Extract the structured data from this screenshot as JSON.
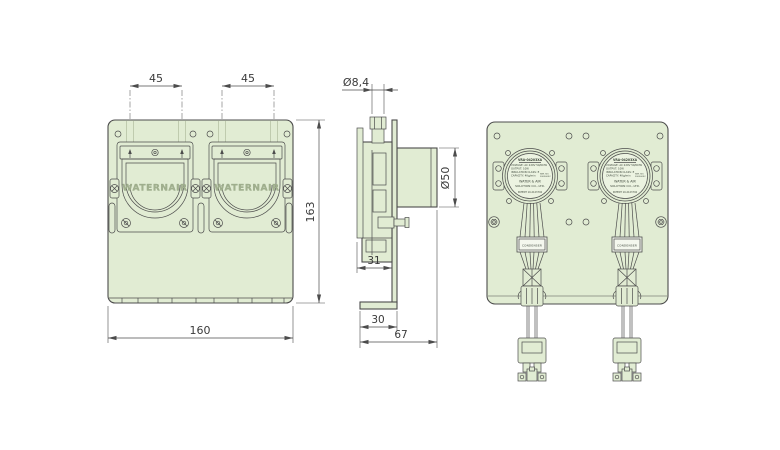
{
  "colors": {
    "background": "#ffffff",
    "panel_fill": "#e1ecd3",
    "line": "#4c4c4c",
    "dim_text": "#3a3a3a",
    "emboss_text": "#a2b18f",
    "nameplate_fill": "#e1ecd3",
    "condenser_fill": "#f4f7ee"
  },
  "front_view": {
    "pump_brand": "WATERNAIR",
    "dims": {
      "port_spacing": [
        "45",
        "45"
      ],
      "height": "163",
      "width": "160"
    }
  },
  "side_view": {
    "dims": {
      "nozzle_diameter": "Ø8,4",
      "motor_diameter": "Ø50",
      "body_depth": "31",
      "foot_depth": "30",
      "total_depth": "67"
    }
  },
  "rear_view": {
    "condenser_label": "CONDENSER",
    "motor_nameplate": {
      "model": "VRA-04203XA",
      "voltage": "VOLTAGE: AC 220V 50/60Hz",
      "output": "OUTPUT: 10W",
      "insulation": "INSULATION CLASS: E",
      "capacity": "CAPACITY: 4Kg/min",
      "serial_label": "SER. NO.",
      "serial_number": "20050032",
      "company_line1": "WATER & AIR",
      "company_line2": "SOLUTION CO., LTD.",
      "patent": "PATENT 10-2123792"
    }
  }
}
